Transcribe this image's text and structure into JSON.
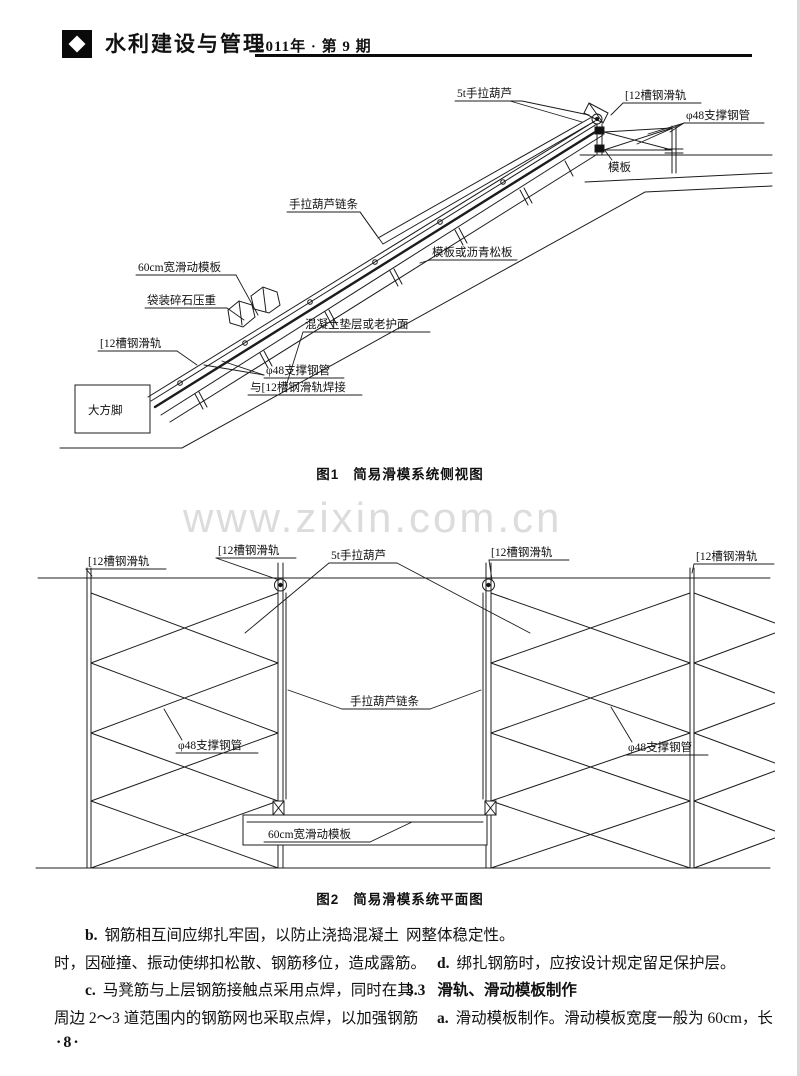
{
  "header": {
    "journal_title": "水利建设与管理",
    "issue": "2011年 · 第 9 期"
  },
  "figure1": {
    "caption_label": "图1",
    "caption_text": "简易滑模系统侧视图",
    "labels": {
      "hoist": "5t手拉葫芦",
      "rail_top": "[12槽钢滑轨",
      "support_pipe_top": "φ48支撑钢管",
      "formwork": "模板",
      "hoist_chain": "手拉葫芦链条",
      "surface_board": "模板或沥青松板",
      "sliding_formwork": "60cm宽滑动模板",
      "gravel_weight": "袋装碎石压重",
      "concrete_cushion": "混凝土垫层或老护面",
      "rail_bottom": "[12槽钢滑轨",
      "support_pipe_weld_1": "φ48支撑钢管",
      "support_pipe_weld_2": "与[12槽钢滑轨焊接",
      "big_foot": "大方脚"
    }
  },
  "watermark": "www.zixin.com.cn",
  "figure2": {
    "caption_label": "图2",
    "caption_text": "简易滑模系统平面图",
    "labels": {
      "rail_1": "[12槽钢滑轨",
      "rail_2": "[12槽钢滑轨",
      "hoist": "5t手拉葫芦",
      "rail_3": "[12槽钢滑轨",
      "rail_4": "[12槽钢滑轨",
      "hoist_chain": "手拉葫芦链条",
      "support_pipe_left": "φ48支撑钢管",
      "support_pipe_right": "φ48支撑钢管",
      "sliding_formwork": "60cm宽滑动模板"
    }
  },
  "body": {
    "left": [
      {
        "lead": "b.",
        "text": "钢筋相互间应绑扎牢固，以防止浇捣混凝土"
      },
      {
        "lead": "",
        "text": "时，因碰撞、振动使绑扣松散、钢筋移位，造成露筋。"
      },
      {
        "lead": "c.",
        "text": "马凳筋与上层钢筋接触点采用点焊，同时在其"
      },
      {
        "lead": "",
        "text": "周边 2～3 道范围内的钢筋网也采取点焊，以加强钢筋"
      }
    ],
    "right": [
      {
        "lead": "",
        "text": "网整体稳定性。"
      },
      {
        "lead": "d.",
        "text": "绑扎钢筋时，应按设计规定留足保护层。"
      },
      {
        "lead": "3.3",
        "text": "滑轨、滑动模板制作"
      },
      {
        "lead": "a.",
        "text": "滑动模板制作。滑动模板宽度一般为 60cm，长"
      }
    ]
  },
  "page_number": "·8·"
}
